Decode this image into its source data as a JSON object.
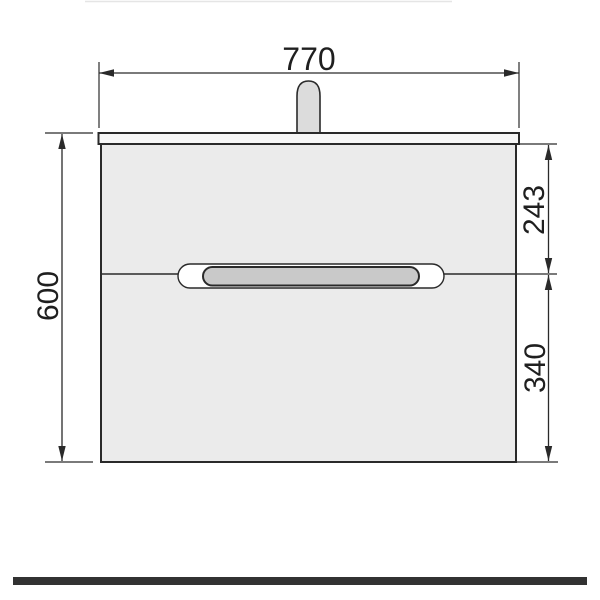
{
  "drawing": {
    "dimension_labels": {
      "width": "770",
      "height": "600",
      "upper_section": "243",
      "lower_section": "340"
    },
    "colors": {
      "line": "#2a2a2a",
      "cabinet_fill": "#ebebeb",
      "countertop_fill": "#f7f7f7",
      "faucet_fill": "#dcdcdc",
      "handle_outer_fill": "#ffffff",
      "handle_inner_fill": "#c9c9c9",
      "footer_bar_fill": "#323232",
      "top_artifact_line": "#e5e5e5"
    }
  }
}
